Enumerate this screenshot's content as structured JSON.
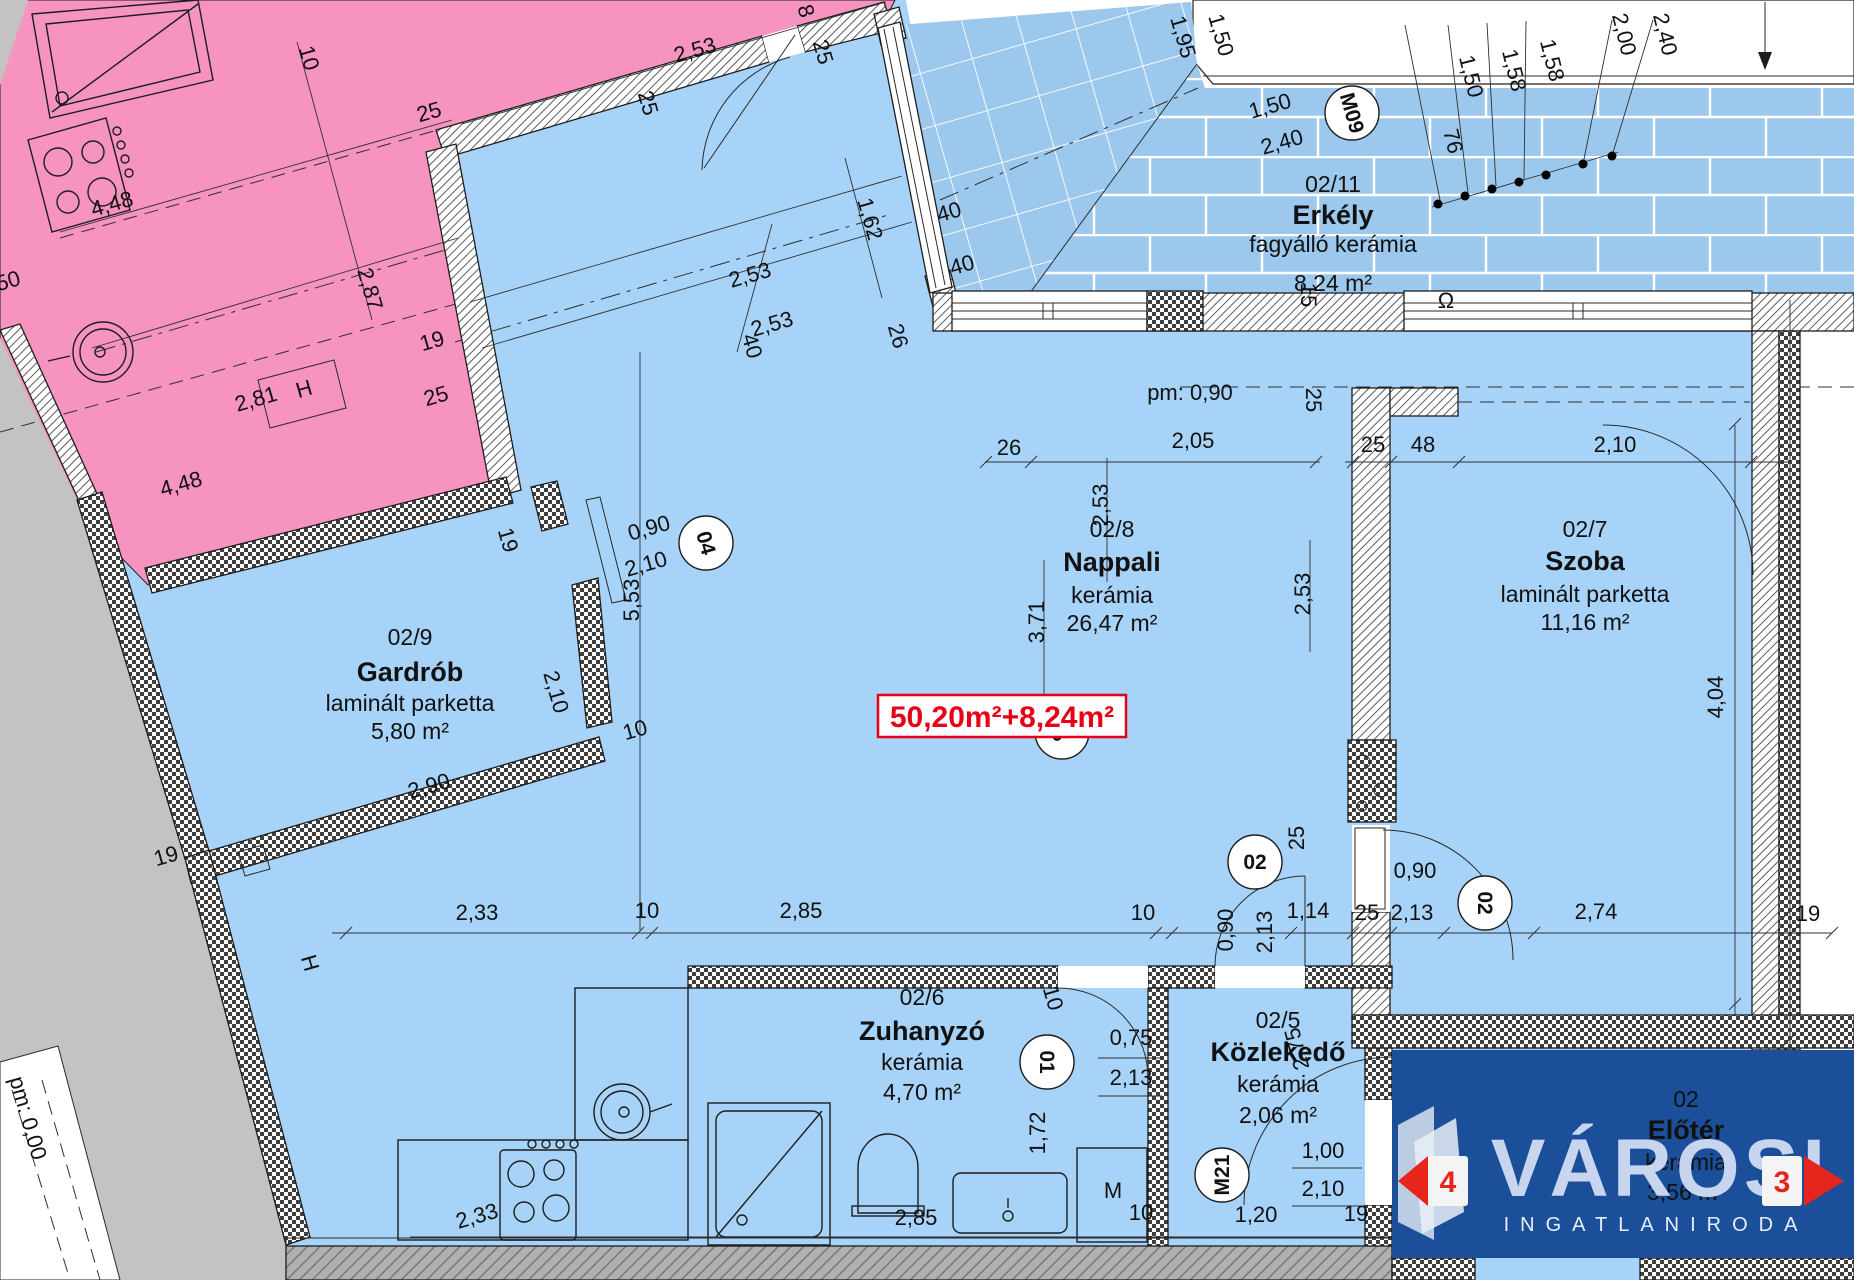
{
  "palette": {
    "apartment_blue": "#a7d3f8",
    "balcony_blue": "#9cc8ee",
    "neighbor_pink": "#f694bf",
    "outside_gray": "#c3c3c3",
    "accent_red": "#e80016",
    "watermark_navy": "#1b4f9a"
  },
  "area_badge": {
    "text": "50,20m²+8,24m²"
  },
  "watermark": {
    "brand": "VÁROSI",
    "sub": "INGATLANIRODA",
    "nav_prev": "4",
    "nav_next": "3"
  },
  "rooms": [
    {
      "num": "02/9",
      "name": "Gardrób",
      "finish": "laminált parketta",
      "area": "5,80 m²",
      "cx": 410,
      "ys": [
        645,
        681,
        711,
        739
      ],
      "dark": false
    },
    {
      "num": "02/8",
      "name": "Nappali",
      "finish": "kerámia",
      "area": "26,47 m²",
      "cx": 1112,
      "ys": [
        537,
        571,
        603,
        631
      ],
      "dark": false
    },
    {
      "num": "02/7",
      "name": "Szoba",
      "finish": "laminált parketta",
      "area": "11,16 m²",
      "cx": 1585,
      "ys": [
        537,
        570,
        602,
        630
      ],
      "dark": false
    },
    {
      "num": "02/11",
      "name": "Erkély",
      "finish": "fagyálló kerámia",
      "area": "8,24 m²",
      "cx": 1333,
      "ys": [
        192,
        224,
        252,
        291
      ],
      "dark": false
    },
    {
      "num": "02/6",
      "name": "Zuhanyzó",
      "finish": "kerámia",
      "area": "4,70 m²",
      "cx": 922,
      "ys": [
        1005,
        1040,
        1070,
        1100
      ],
      "dark": false
    },
    {
      "num": "02/5",
      "name": "Közlekedő",
      "finish": "kerámia",
      "area": "2,06 m²",
      "cx": 1278,
      "ys": [
        1028,
        1061,
        1092,
        1123
      ],
      "dark": false
    },
    {
      "num": "02",
      "name": "Előtér",
      "finish": "kerámia",
      "area": "3,56 m²",
      "cx": 1686,
      "ys": [
        1107,
        1139,
        1170,
        1200
      ],
      "dark": true
    }
  ],
  "door_markers": [
    {
      "label": "04",
      "x": 706,
      "y": 543,
      "r": 74
    },
    {
      "label": "M09",
      "x": 1352,
      "y": 113,
      "r": 74
    },
    {
      "label": "02",
      "x": 1062,
      "y": 732,
      "r": -16
    },
    {
      "label": "02",
      "x": 1255,
      "y": 862,
      "r": 0
    },
    {
      "label": "02",
      "x": 1485,
      "y": 903,
      "r": 90
    },
    {
      "label": "01",
      "x": 1047,
      "y": 1062,
      "r": 90
    },
    {
      "label": "M21",
      "x": 1222,
      "y": 1175,
      "r": -90
    },
    {
      "label": "M21",
      "x": 1610,
      "y": 1112,
      "r": 0
    }
  ],
  "dim_labels": [
    {
      "t": "10",
      "x": 302,
      "y": 60,
      "r": 74
    },
    {
      "t": "25",
      "x": 431,
      "y": 119,
      "r": -16
    },
    {
      "t": "2,53",
      "x": 697,
      "y": 57,
      "r": -16
    },
    {
      "t": "8",
      "x": 799,
      "y": 13,
      "r": 74
    },
    {
      "t": "25",
      "x": 816,
      "y": 54,
      "r": 74
    },
    {
      "t": "25",
      "x": 641,
      "y": 105,
      "r": 74
    },
    {
      "t": "4,48",
      "x": 114,
      "y": 211,
      "r": -16
    },
    {
      "t": "2,87",
      "x": 363,
      "y": 291,
      "r": 74
    },
    {
      "t": "19",
      "x": 434,
      "y": 348,
      "r": -16
    },
    {
      "t": "2,81",
      "x": 258,
      "y": 406,
      "r": -16
    },
    {
      "t": "25",
      "x": 438,
      "y": 403,
      "r": -16
    },
    {
      "t": "50",
      "x": 10,
      "y": 288,
      "r": -16
    },
    {
      "t": "4,48",
      "x": 183,
      "y": 491,
      "r": -16
    },
    {
      "t": "H",
      "x": 306,
      "y": 396,
      "r": -16
    },
    {
      "t": "2,53",
      "x": 752,
      "y": 282,
      "r": -16
    },
    {
      "t": "2,53",
      "x": 774,
      "y": 331,
      "r": -16
    },
    {
      "t": "40",
      "x": 745,
      "y": 348,
      "r": 74
    },
    {
      "t": "1,62",
      "x": 863,
      "y": 221,
      "r": 74
    },
    {
      "t": "26",
      "x": 891,
      "y": 338,
      "r": 74
    },
    {
      "t": "40",
      "x": 951,
      "y": 219,
      "r": -16
    },
    {
      "t": "40",
      "x": 964,
      "y": 272,
      "r": -16
    },
    {
      "t": "1,95",
      "x": 1176,
      "y": 39,
      "r": 74
    },
    {
      "t": "1,50",
      "x": 1214,
      "y": 37,
      "r": 74
    },
    {
      "t": "1,50",
      "x": 1272,
      "y": 113,
      "r": -16
    },
    {
      "t": "2,40",
      "x": 1284,
      "y": 149,
      "r": -16
    },
    {
      "t": "1,50",
      "x": 1464,
      "y": 78,
      "r": 76
    },
    {
      "t": "1,58",
      "x": 1507,
      "y": 72,
      "r": 76
    },
    {
      "t": "1,58",
      "x": 1545,
      "y": 62,
      "r": 76
    },
    {
      "t": "2,00",
      "x": 1617,
      "y": 36,
      "r": 76
    },
    {
      "t": "2,40",
      "x": 1658,
      "y": 36,
      "r": 76
    },
    {
      "t": "76",
      "x": 1446,
      "y": 143,
      "r": 76
    },
    {
      "t": "15",
      "x": 1301,
      "y": 295,
      "r": 90
    },
    {
      "t": "pm: 0,90",
      "x": 1190,
      "y": 400,
      "r": 0
    },
    {
      "t": "26",
      "x": 1009,
      "y": 455,
      "r": 0
    },
    {
      "t": "2,05",
      "x": 1193,
      "y": 448,
      "r": 0
    },
    {
      "t": "25",
      "x": 1306,
      "y": 400,
      "r": 90
    },
    {
      "t": "25",
      "x": 1373,
      "y": 452,
      "r": 0
    },
    {
      "t": "48",
      "x": 1423,
      "y": 452,
      "r": 0
    },
    {
      "t": "2,10",
      "x": 1615,
      "y": 452,
      "r": 0
    },
    {
      "t": "2,53",
      "x": 1310,
      "y": 594,
      "r": -90
    },
    {
      "t": "2,53",
      "x": 1108,
      "y": 505,
      "r": -90
    },
    {
      "t": "3,71",
      "x": 1044,
      "y": 622,
      "r": -90
    },
    {
      "t": "5,53",
      "x": 639,
      "y": 600,
      "r": -90
    },
    {
      "t": "0,90",
      "x": 651,
      "y": 535,
      "r": -16
    },
    {
      "t": "2,10",
      "x": 648,
      "y": 571,
      "r": -16
    },
    {
      "t": "19",
      "x": 501,
      "y": 542,
      "r": 74
    },
    {
      "t": "2,10",
      "x": 549,
      "y": 694,
      "r": 74
    },
    {
      "t": "10",
      "x": 637,
      "y": 737,
      "r": -16
    },
    {
      "t": "2,90",
      "x": 431,
      "y": 793,
      "r": -16
    },
    {
      "t": "19",
      "x": 168,
      "y": 863,
      "r": -16
    },
    {
      "t": "H",
      "x": 303,
      "y": 965,
      "r": 74
    },
    {
      "t": "2,33",
      "x": 477,
      "y": 920,
      "r": 0
    },
    {
      "t": "10",
      "x": 647,
      "y": 918,
      "r": 0
    },
    {
      "t": "2,85",
      "x": 801,
      "y": 918,
      "r": 0
    },
    {
      "t": "10",
      "x": 1143,
      "y": 920,
      "r": 0
    },
    {
      "t": "0,90",
      "x": 1233,
      "y": 930,
      "r": -90
    },
    {
      "t": "2,13",
      "x": 1272,
      "y": 932,
      "r": -90
    },
    {
      "t": "1,14",
      "x": 1308,
      "y": 918,
      "r": 0
    },
    {
      "t": "25",
      "x": 1367,
      "y": 920,
      "r": 0
    },
    {
      "t": "2,13",
      "x": 1412,
      "y": 920,
      "r": 0
    },
    {
      "t": "2,74",
      "x": 1596,
      "y": 919,
      "r": 0
    },
    {
      "t": "19",
      "x": 1808,
      "y": 921,
      "r": 0
    },
    {
      "t": "0,90",
      "x": 1415,
      "y": 878,
      "r": 0
    },
    {
      "t": "25",
      "x": 1304,
      "y": 838,
      "r": -90
    },
    {
      "t": "4,04",
      "x": 1723,
      "y": 697,
      "r": -90
    },
    {
      "t": "10",
      "x": 1046,
      "y": 1000,
      "r": 74
    },
    {
      "t": "0,75",
      "x": 1131,
      "y": 1045,
      "r": 0
    },
    {
      "t": "2,13",
      "x": 1131,
      "y": 1085,
      "r": 0
    },
    {
      "t": "1,72",
      "x": 1045,
      "y": 1133,
      "r": -90
    },
    {
      "t": "M",
      "x": 1113,
      "y": 1198,
      "r": 0
    },
    {
      "t": "10",
      "x": 1141,
      "y": 1220,
      "r": 0
    },
    {
      "t": "2,75",
      "x": 1304,
      "y": 1047,
      "r": -105
    },
    {
      "t": "1,00",
      "x": 1323,
      "y": 1158,
      "r": 0
    },
    {
      "t": "2,10",
      "x": 1323,
      "y": 1196,
      "r": 0
    },
    {
      "t": "1,20",
      "x": 1256,
      "y": 1222,
      "r": 0
    },
    {
      "t": "19",
      "x": 1356,
      "y": 1221,
      "r": 0
    },
    {
      "t": "2,33",
      "x": 479,
      "y": 1223,
      "r": -16
    },
    {
      "t": "2,85",
      "x": 916,
      "y": 1225,
      "r": 0
    },
    {
      "t": "pm: 0,00",
      "x": 21,
      "y": 1120,
      "r": 74
    },
    {
      "t": "Ω",
      "x": 1446,
      "y": 308,
      "r": 0
    },
    {
      "t": "19",
      "x": 1746,
      "y": 1070,
      "r": -90,
      "c": "#33415e"
    },
    {
      "t": "1,00",
      "x": 1591,
      "y": 1216,
      "r": -90,
      "c": "#33415e"
    },
    {
      "t": "2,10",
      "x": 1632,
      "y": 1220,
      "r": -90,
      "c": "#33415e"
    },
    {
      "t": "2,74",
      "x": 1503,
      "y": 1222,
      "r": -16,
      "c": "#33415e"
    },
    {
      "t": "19",
      "x": 1808,
      "y": 1223,
      "r": -16,
      "c": "#33415e"
    }
  ]
}
